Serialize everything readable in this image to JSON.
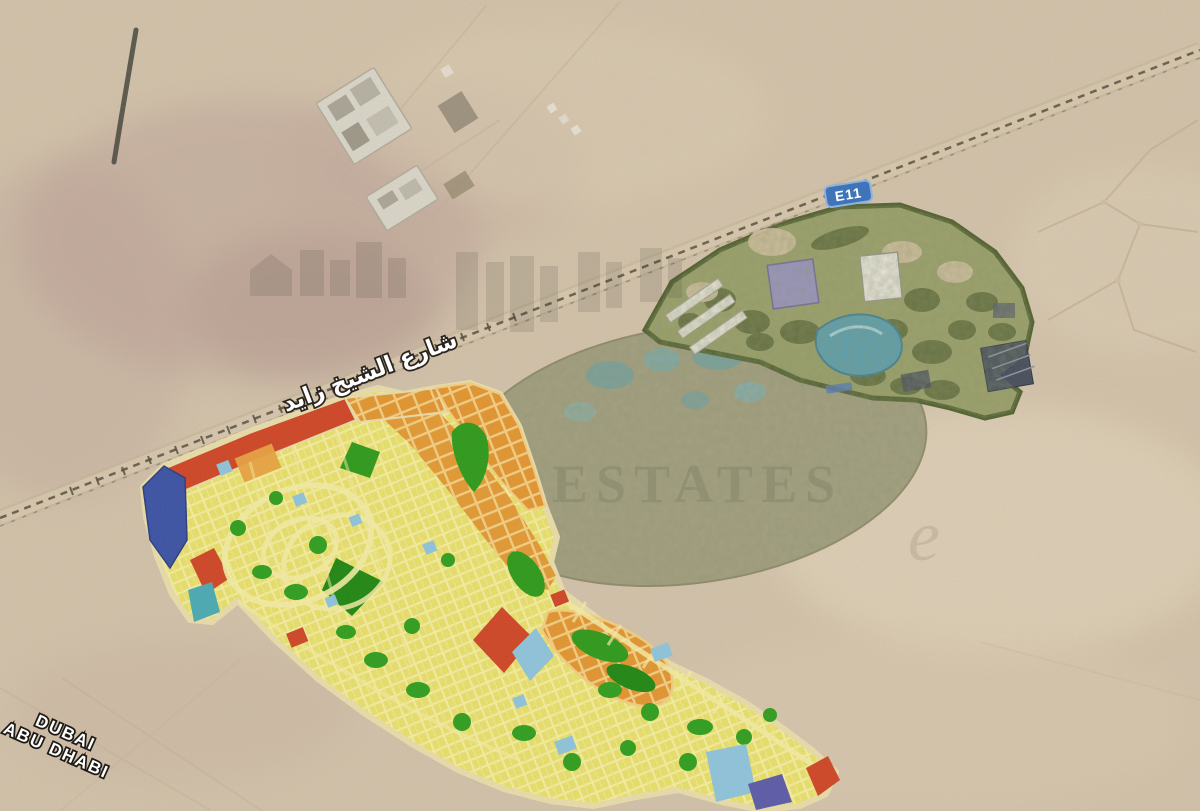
{
  "map": {
    "highway_badge": "E11",
    "road_name_arabic": "شارع الشيخ زايد",
    "direction_labels": {
      "line1": "DUBAI",
      "line2": "ABU DHABI"
    },
    "watermark": {
      "brand_text": "ESTATES",
      "flourish_letter": "e"
    },
    "colors": {
      "desert": "#d2c2aa",
      "residential_yellow": "#e8e06a",
      "street_cream": "#f6f0a6",
      "commercial_orange": "#e2952f",
      "parcel_red": "#cf4526",
      "park_green": "#2f9e1e",
      "water_cyan": "#8ec4dc",
      "parcel_blue": "#3a52a5",
      "resort_olive": "#9aa168",
      "lake_teal": "#57a0b4",
      "badge_blue": "#3f74b8"
    }
  }
}
